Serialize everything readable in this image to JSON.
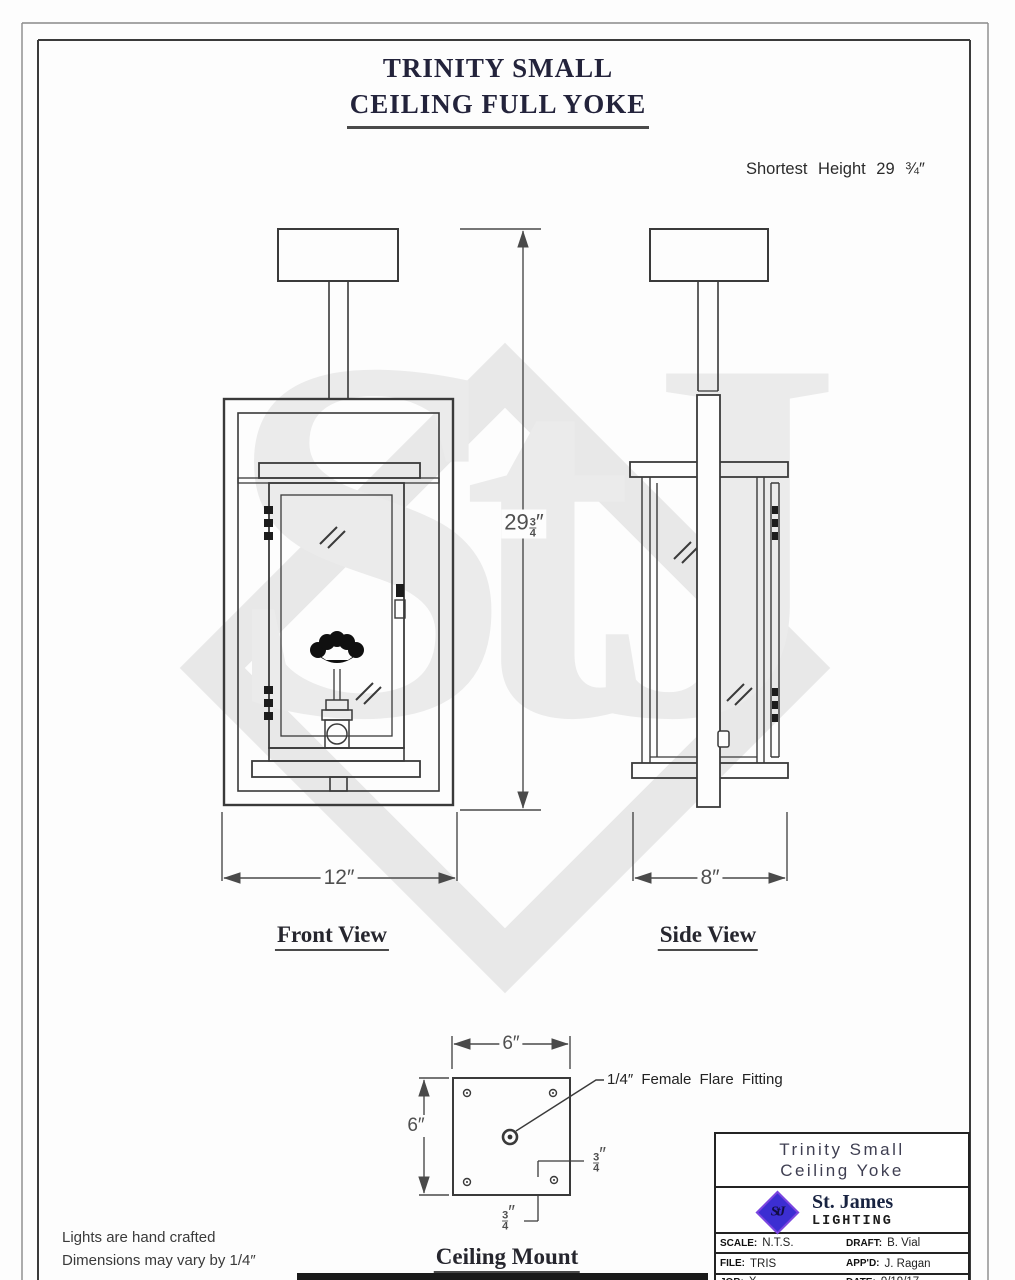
{
  "page": {
    "title_line1": "TRINITY SMALL",
    "title_line2": "CEILING FULL YOKE",
    "shortest_height_note": "Shortest Height 29 ¾″",
    "notes_line1": "Lights are hand crafted",
    "notes_line2": "Dimensions may vary by 1/4″"
  },
  "views": {
    "front": {
      "label": "Front View",
      "width_dim": "12″",
      "height_dim": {
        "whole": "29",
        "num": "3",
        "den": "4",
        "unit": "″"
      }
    },
    "side": {
      "label": "Side View",
      "width_dim": "8″"
    },
    "mount": {
      "label": "Ceiling Mount",
      "width_dim": "6″",
      "height_dim": "6″",
      "fitting_callout": "1/4″ Female Flare Fitting",
      "offset_right": {
        "num": "3",
        "den": "4",
        "unit": "″"
      },
      "offset_bottom": {
        "num": "3",
        "den": "4",
        "unit": "″"
      }
    }
  },
  "title_block": {
    "product_line1": "Trinity Small",
    "product_line2": "Ceiling Yoke",
    "company_name": "St. James",
    "company_sub": "LIGHTING",
    "logo_text": "StJ",
    "fields": [
      {
        "label": "SCALE:",
        "value": "N.T.S."
      },
      {
        "label": "DRAFT:",
        "value": "B. Vial"
      },
      {
        "label": "FILE:",
        "value": "TRIS"
      },
      {
        "label": "APP'D:",
        "value": "J. Ragan"
      },
      {
        "label": "JOB:",
        "value": "X"
      },
      {
        "label": "DATE:",
        "value": "9/19/17"
      }
    ]
  },
  "watermark": {
    "text": "StJ"
  },
  "colors": {
    "line": "#3a3a3a",
    "dim_line": "#4a4a4a",
    "watermark": "#e8e8e8",
    "logo_blue": "#3c2ed2",
    "title_navy": "#23233b"
  }
}
